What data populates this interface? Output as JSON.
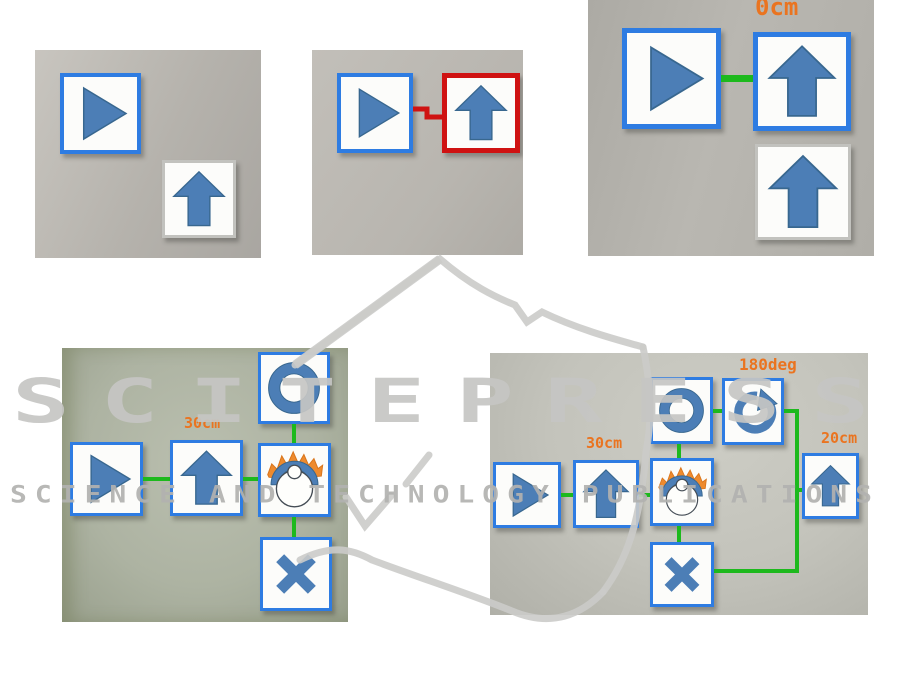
{
  "watermark": {
    "logo_text": "SCITEPRESS",
    "tagline": "SCIENCE AND TECHNOLOGY PUBLICATIONS"
  },
  "panels": {
    "panel1": {
      "description": "start card and move-forward card, not connected"
    },
    "panel2": {
      "description": "start card linked to move-forward card by red error connector"
    },
    "panel3": {
      "distance_label": "0cm"
    },
    "panel4": {
      "distance_label": "30cm"
    },
    "panel5": {
      "distance_label_forward": "30cm",
      "angle_label": "180deg",
      "distance_label_forward2": "20cm"
    }
  },
  "colors": {
    "card_border_active": "#2e7ce2",
    "card_border_error": "#cf1212",
    "card_border_unrecognized": "#c2c2be",
    "connector_ok": "#1db91d",
    "connector_error": "#cf1212",
    "icon_blue": "#4c7eb6",
    "sensor_spark_orange": "#ee8a2d",
    "label_orange": "#ea7420",
    "watermark_grey": "#c6c6c4"
  }
}
